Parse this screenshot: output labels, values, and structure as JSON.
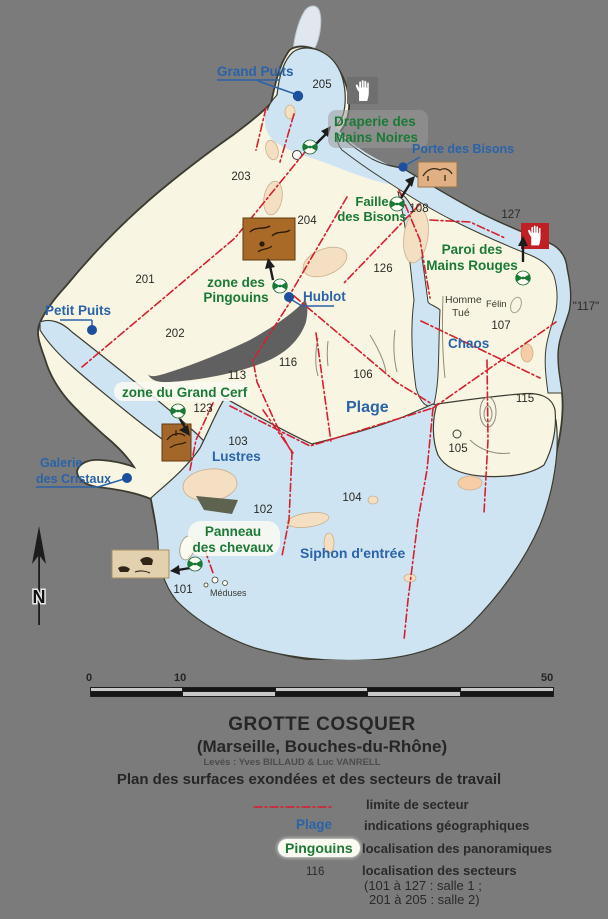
{
  "map": {
    "geo": {
      "grand_puits": "Grand Puits",
      "petit_puits": "Petit Puits",
      "porte_des_bisons": "Porte des Bisons",
      "hublot": "Hublot",
      "galerie_line1": "Galerie",
      "galerie_line2": "des Cristaux",
      "plage": "Plage",
      "chaos": "Chaos",
      "lustres": "Lustres",
      "siphon": "Siphon d'entrée",
      "meduses": "Méduses",
      "homme_line1": "Homme",
      "homme_line2": "Tué",
      "felin": "Félin"
    },
    "pano": {
      "draperie_line1": "Draperie des",
      "draperie_line2": "Mains Noires",
      "faille_line1": "Faille",
      "faille_line2": "des Bisons",
      "paroi_line1": "Paroi des",
      "paroi_line2": "Mains Rouges",
      "pingouins_line1": "zone des",
      "pingouins_line2": "Pingouins",
      "grand_cerf": "zone du Grand Cerf",
      "chevaux_line1": "Panneau",
      "chevaux_line2": "des chevaux"
    },
    "sectors": {
      "s201": "201",
      "s202": "202",
      "s203": "203",
      "s204": "204",
      "s205": "205",
      "s101": "101",
      "s102": "102",
      "s103": "103",
      "s104": "104",
      "s105": "105",
      "s106": "106",
      "s107": "107",
      "s108": "108",
      "s113": "113",
      "s115": "115",
      "s116": "116",
      "s123": "123",
      "s126": "126",
      "s127": "127",
      "s117": "\"117\""
    },
    "north_label": "N"
  },
  "scalebar": {
    "tick0": "0",
    "tick10": "10",
    "tick50": "50"
  },
  "title": {
    "main": "GROTTE COSQUER",
    "sub": "(Marseille, Bouches-du-Rhône)",
    "credits": "Levés : Yves BILLAUD & Luc VANRELL",
    "plan": "Plan des surfaces exondées et des secteurs de travail"
  },
  "legend": {
    "limit_label": "limite de secteur",
    "geo_sample": "Plage",
    "geo_label": "indications géographiques",
    "pano_sample": "Pingouins",
    "pano_label": "localisation des panoramiques",
    "sector_sample": "116",
    "sector_label": "localisation des secteurs",
    "sector_note1": "(101 à 127 : salle 1 ;",
    "sector_note2": "201 à 205 : salle 2)"
  },
  "colors": {
    "background": "#7b7b7b",
    "cave_floor": "#f8f5e2",
    "water": "#cfe4f2",
    "sector_line_red": "#d6202d",
    "geo_blue": "#2b63a8",
    "pano_green": "#1a7a35",
    "hand_red": "#c01f26",
    "hand_gray": "#6f6f6f"
  }
}
